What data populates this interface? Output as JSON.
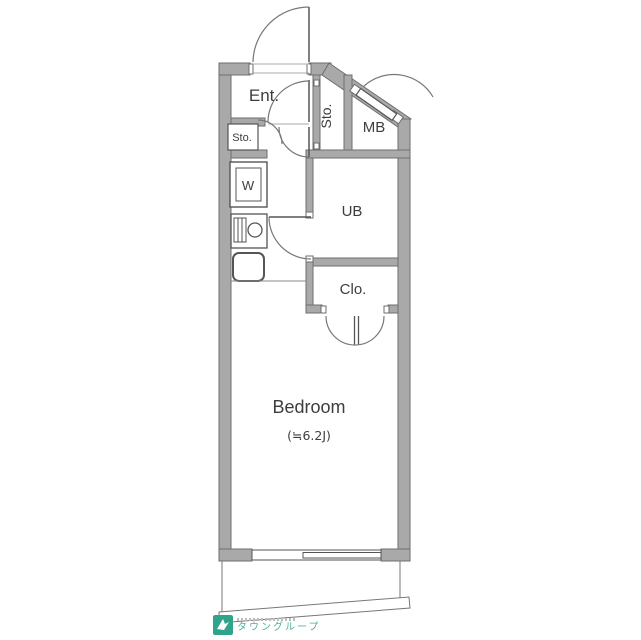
{
  "title": "floor-plan",
  "labels": {
    "ent": "Ent.",
    "sto_vertical": "Sto.",
    "sto_left": "Sto.",
    "mb": "MB",
    "washer": "W",
    "ub": "UB",
    "clo": "Clo.",
    "bedroom": "Bedroom",
    "bedroom_size": "(≒6.2J)"
  },
  "logo": {
    "text": "タウングループ"
  },
  "colors": {
    "wall_fill": "#a9a9a9",
    "wall_stroke": "#6e6e6e",
    "thin_line": "#777777",
    "fixture_line": "#555555",
    "text": "#3d3d3d",
    "logo_teal": "#2fa48b"
  }
}
